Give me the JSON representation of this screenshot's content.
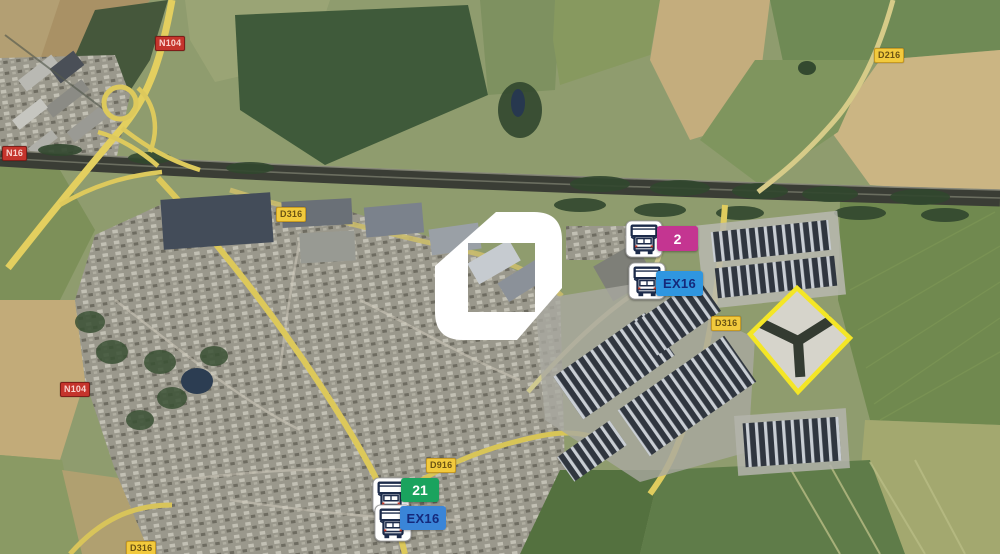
{
  "map": {
    "kind": "satellite-aerial-view",
    "logo": {
      "name": "brand-logo",
      "color": "#ffffff"
    },
    "road_badges": [
      {
        "label": "N104",
        "class": "national"
      },
      {
        "label": "N16",
        "class": "national"
      },
      {
        "label": "N104",
        "class": "national"
      },
      {
        "label": "D316",
        "class": "departmental"
      },
      {
        "label": "D216",
        "class": "departmental"
      },
      {
        "label": "D316",
        "class": "departmental"
      },
      {
        "label": "D916",
        "class": "departmental"
      },
      {
        "label": "D316",
        "class": "departmental"
      }
    ],
    "markers": [
      {
        "icon": "truck-icon",
        "label": "2",
        "badge_color": "#c43591",
        "label_color": "#ffffff"
      },
      {
        "icon": "truck-icon",
        "label": "EX16",
        "badge_color": "#2f96e0",
        "label_color": "#15297b"
      },
      {
        "icon": "truck-icon",
        "label": "21",
        "badge_color": "#1aa35e",
        "label_color": "#ffffff"
      },
      {
        "icon": "truck-icon",
        "label": "EX16",
        "badge_color": "#3a85d8",
        "label_color": "#15297b"
      }
    ],
    "selected_site": {
      "outline_color": "#f4e626"
    },
    "palette": {
      "highway_yellow": "#e3cf5f",
      "field_green": "#6f8a55",
      "field_tan": "#c4ad7d",
      "warehouse_roof": "#30363f",
      "corridor_dark": "#3a3d35"
    }
  }
}
